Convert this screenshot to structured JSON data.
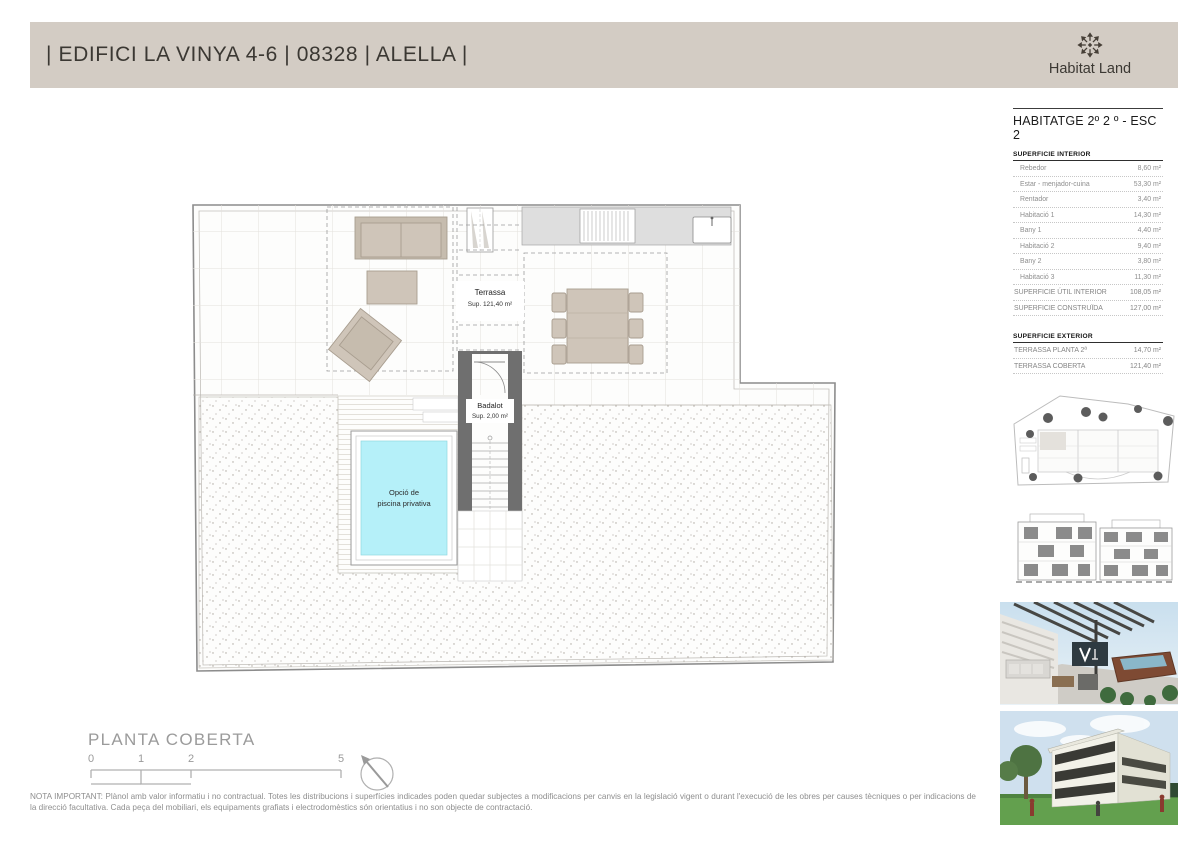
{
  "header": {
    "title": "| EDIFICI LA VINYA 4-6 | 08328 | ALELLA |",
    "brand": "Habitat Land",
    "header_bg": "#d3ccc4"
  },
  "sidebar": {
    "title": "HABITATGE 2º 2 º - ESC 2",
    "interior": {
      "heading": "SUPERFICIE INTERIOR",
      "rows": [
        {
          "label": "Rebedor",
          "value": "8,60 m²"
        },
        {
          "label": "Estar - menjador-cuina",
          "value": "53,30 m²"
        },
        {
          "label": "Rentador",
          "value": "3,40 m²"
        },
        {
          "label": "Habitació 1",
          "value": "14,30 m²"
        },
        {
          "label": "Bany 1",
          "value": "4,40 m²"
        },
        {
          "label": "Habitació 2",
          "value": "9,40 m²"
        },
        {
          "label": "Bany 2",
          "value": "3,80 m²"
        },
        {
          "label": "Habitació 3",
          "value": "11,30 m²"
        },
        {
          "label": "SUPERFICIE ÚTIL INTERIOR",
          "value": "108,05 m²"
        },
        {
          "label": "SUPERFICIE CONSTRUÏDA",
          "value": "127,00 m²"
        }
      ]
    },
    "exterior": {
      "heading": "SUPERFICIE EXTERIOR",
      "rows": [
        {
          "label": "TERRASSA PLANTA 2ª",
          "value": "14,70 m²"
        },
        {
          "label": "TERRASSA COBERTA",
          "value": "121,40 m²"
        }
      ]
    },
    "thumbnails": [
      "site-plan-drawing",
      "facade-elevation-drawing",
      "terrace-render-image",
      "building-render-image"
    ]
  },
  "plan": {
    "labels": {
      "terrassa_name": "Terrassa",
      "terrassa_sup": "Sup. 121,40 m²",
      "badalot_name": "Badalot",
      "badalot_sup": "Sup. 2,00 m²",
      "pool_line1": "Opció de",
      "pool_line2": "piscina privativa"
    },
    "colors": {
      "pool_water": "#b5f0f9",
      "badalot_wall": "#6f6f6f",
      "furniture": "#cfc5b9"
    }
  },
  "footer": {
    "plan_title": "PLANTA COBERTA",
    "scale_ticks": [
      "0",
      "1",
      "2",
      "5"
    ],
    "note": "NOTA IMPORTANT: Plànol amb valor informatiu i no contractual. Totes les distribucions i superfícies indicades poden quedar subjectes a modificacions per canvis en la legislació vigent o durant l'execució de les obres per causes tècniques o per indicacions de la direcció facultativa. Cada peça del mobiliari, els equipaments grafiats i electrodomèstics són orientatius i no son objecte de contractació."
  }
}
